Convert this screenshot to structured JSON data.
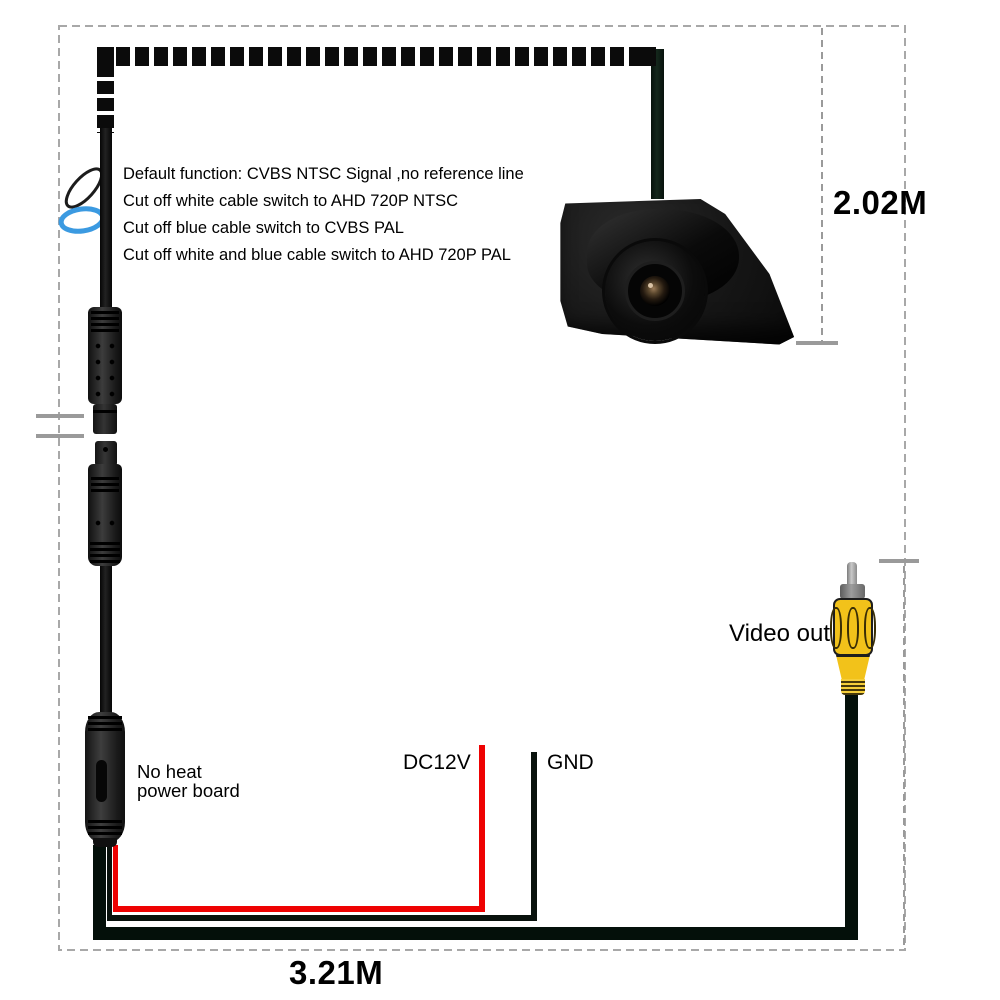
{
  "info_block": {
    "lines": [
      "Default function: CVBS NTSC Signal ,no reference line",
      "Cut off white cable switch to AHD 720P NTSC",
      "Cut off blue cable switch to CVBS PAL",
      "Cut off white and blue cable switch to AHD 720P PAL"
    ]
  },
  "measurements": {
    "camera_cable_length": "2.02M",
    "total_cable_length": "3.21M"
  },
  "wiring": {
    "power_label": "DC12V",
    "ground_label": "GND",
    "video_out_label": "Video out"
  },
  "power_board": {
    "line1": "No heat",
    "line2": "power board"
  },
  "colors": {
    "wire_red": "#ee0202",
    "wire_black": "#0a0f0d",
    "loop_blue": "#3b9ae1",
    "loop_white": "#ffffff",
    "rca_yellow": "#f2c21a",
    "measure_gray": "#9a9a9a",
    "border_gray": "#a8a8a8",
    "cable_black": "#0b0b0b"
  }
}
